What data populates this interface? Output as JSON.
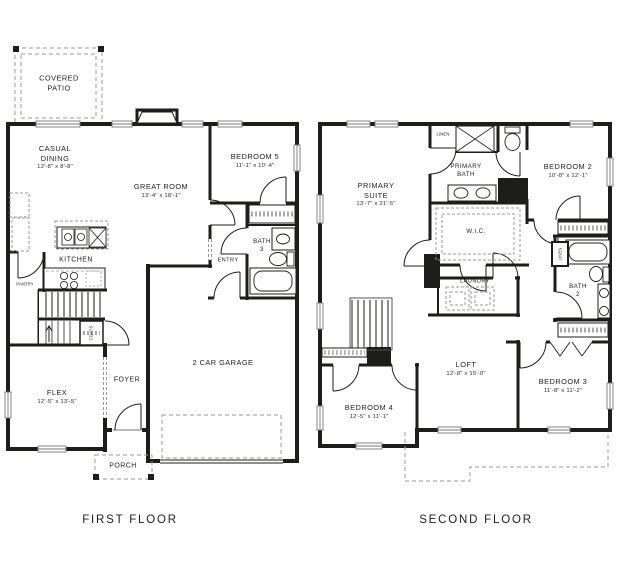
{
  "figure": {
    "type": "two-story house floor plan"
  },
  "colors": {
    "wall": "#1d1d1b",
    "dash": "#999999",
    "window": "#777777",
    "text": "#232323",
    "background": "#ffffff"
  },
  "first_floor": {
    "caption": "FIRST FLOOR",
    "rooms": {
      "covered_patio": {
        "name": "COVERED\nPATIO"
      },
      "casual_dining": {
        "name": "CASUAL\nDINING",
        "dims": "12'-8\" x 8'-8\""
      },
      "great_room": {
        "name": "GREAT ROOM",
        "dims": "13'-4\" x 18'-1\""
      },
      "bedroom5": {
        "name": "BEDROOM 5",
        "dims": "11'-1\" x 10'-4\""
      },
      "bath3": {
        "name": "BATH\n3"
      },
      "entry": {
        "name": "ENTRY"
      },
      "kitchen": {
        "name": "KITCHEN"
      },
      "pantry": {
        "name": "PANTRY"
      },
      "coats": {
        "name": "COATS"
      },
      "flex": {
        "name": "FLEX",
        "dims": "12'-5\" x 13'-5\""
      },
      "foyer": {
        "name": "FOYER"
      },
      "garage": {
        "name": "2 CAR GARAGE"
      },
      "porch": {
        "name": "PORCH"
      }
    }
  },
  "second_floor": {
    "caption": "SECOND FLOOR",
    "rooms": {
      "primary_suite": {
        "name": "PRIMARY\nSUITE",
        "dims": "13'-7\" x 21'-5\""
      },
      "linen_top": {
        "name": "LINEN"
      },
      "primary_bath": {
        "name": "PRIMARY\nBATH"
      },
      "bedroom2": {
        "name": "BEDROOM 2",
        "dims": "10'-8\" x 12'-1\""
      },
      "wic": {
        "name": "W.I.C."
      },
      "laundry": {
        "name": "LAUNDRY"
      },
      "bath2": {
        "name": "BATH\n2"
      },
      "linen_side": {
        "name": "LINEN"
      },
      "loft": {
        "name": "LOFT",
        "dims": "12'-8\" x 15'-0\""
      },
      "bedroom4": {
        "name": "BEDROOM 4",
        "dims": "12'-5\" x 11'-1\""
      },
      "bedroom3": {
        "name": "BEDROOM 3",
        "dims": "11'-8\" x 11'-2\""
      }
    }
  }
}
